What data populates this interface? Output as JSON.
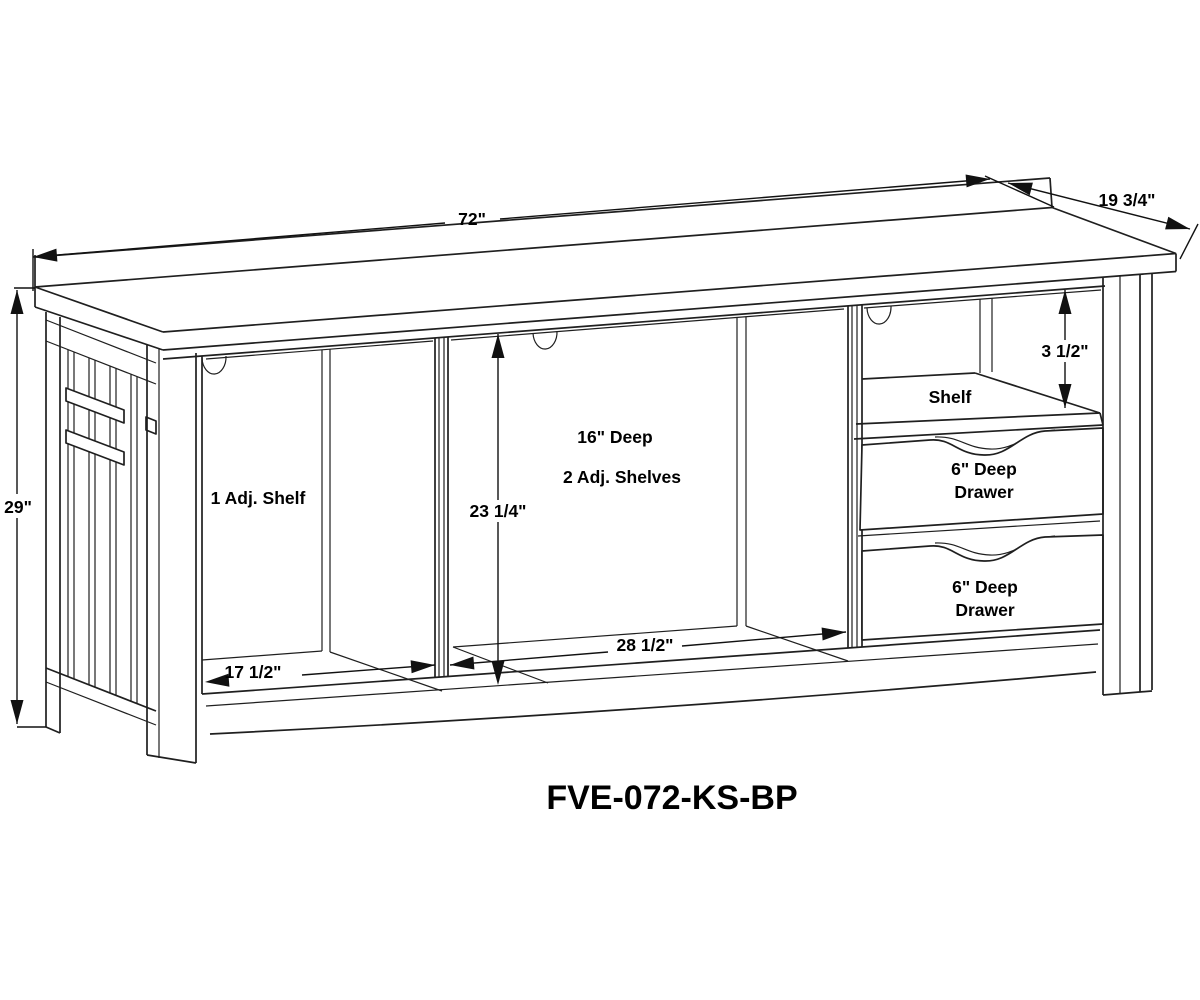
{
  "title": {
    "product_code": "FVE-072-KS-BP"
  },
  "dimensions": {
    "overall_width": "72\"",
    "overall_depth": "19 3/4\"",
    "overall_height": "29\"",
    "left_opening_width": "17 1/2\"",
    "center_opening_width": "28 1/2\"",
    "interior_height": "23 1/4\"",
    "top_opening_height": "3 1/2\""
  },
  "labels": {
    "left_compartment": "1 Adj. Shelf",
    "center_depth": "16\" Deep",
    "center_shelves": "2 Adj. Shelves",
    "fixed_shelf": "Shelf",
    "drawer_top_line1": "6\" Deep",
    "drawer_top_line2": "Drawer",
    "drawer_bottom_line1": "6\" Deep",
    "drawer_bottom_line2": "Drawer"
  },
  "colors": {
    "background": "#ffffff",
    "line": "#1f1f1f",
    "text": "#000000"
  }
}
